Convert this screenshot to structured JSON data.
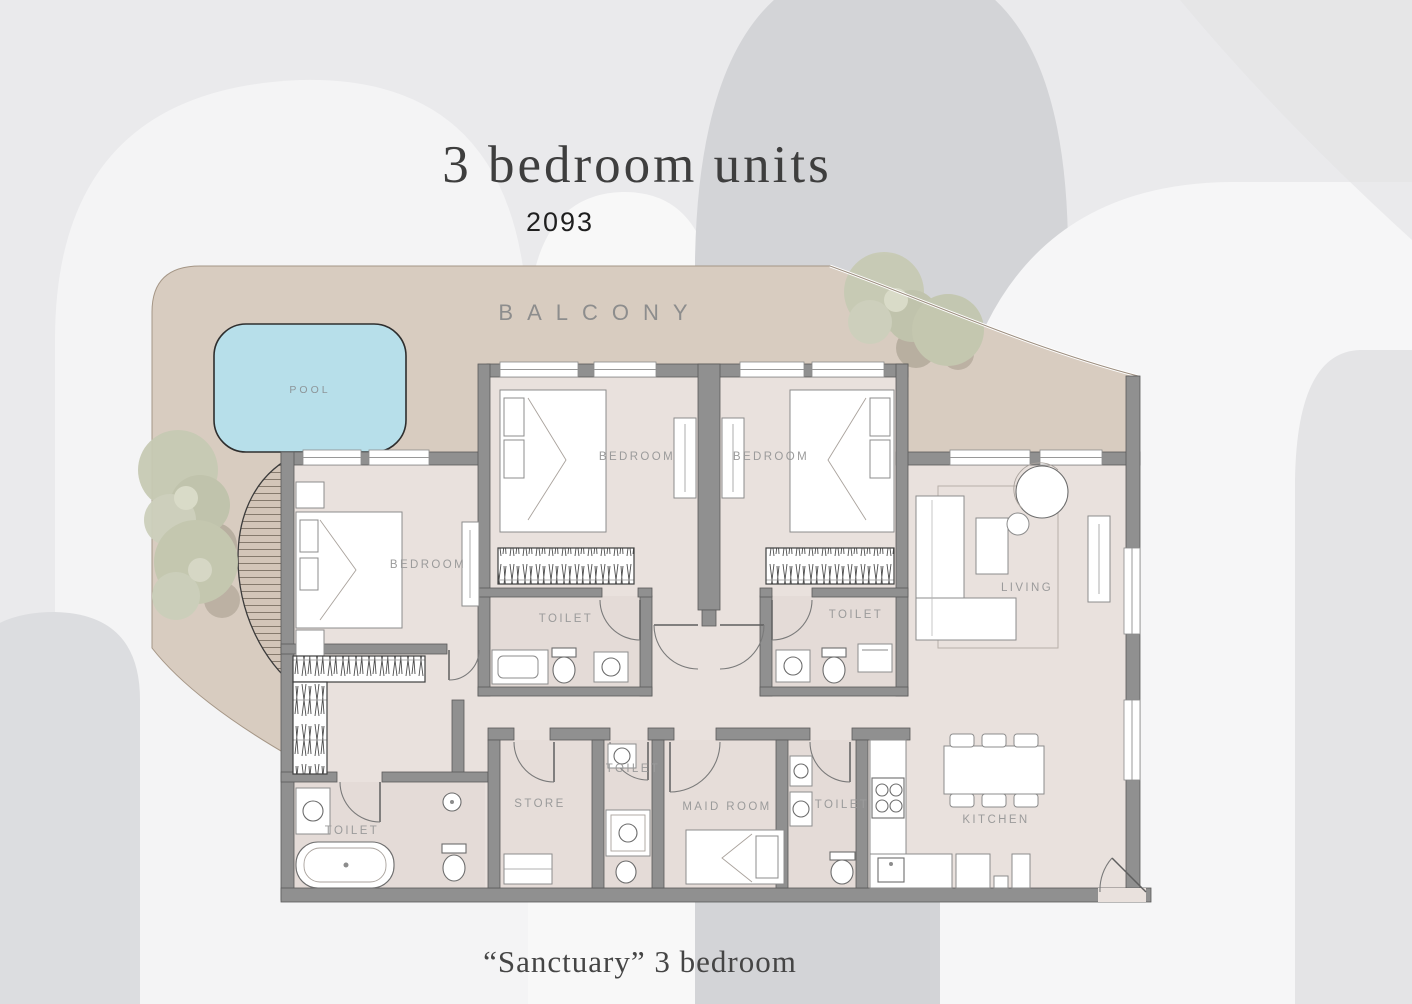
{
  "header": {
    "title": "3 bedroom units",
    "unit_number": "2093"
  },
  "caption": "“Sanctuary” 3 bedroom",
  "plan": {
    "balcony_label": "BALCONY",
    "pool_label": "POOL",
    "room_labels": {
      "bedroom_top_left": "BEDROOM",
      "bedroom_top_right": "BEDROOM",
      "bedroom_master": "BEDROOM",
      "toilet_ensuite_left": "TOILET",
      "toilet_ensuite_right": "TOILET",
      "living": "LIVING",
      "toilet_master": "TOILET",
      "store": "STORE",
      "toilet_guest": "TOILET",
      "maid_room": "MAID ROOM",
      "toilet_service": "TOILET",
      "kitchen": "KITCHEN"
    }
  },
  "colors": {
    "balcony": "#d8ccc0",
    "pool": "#b7dfea",
    "floor": "#e9e1dd",
    "wall": "#909090",
    "tree": "#c6c9b3",
    "label": "#9b9b9b",
    "background": "#eaeaec"
  }
}
